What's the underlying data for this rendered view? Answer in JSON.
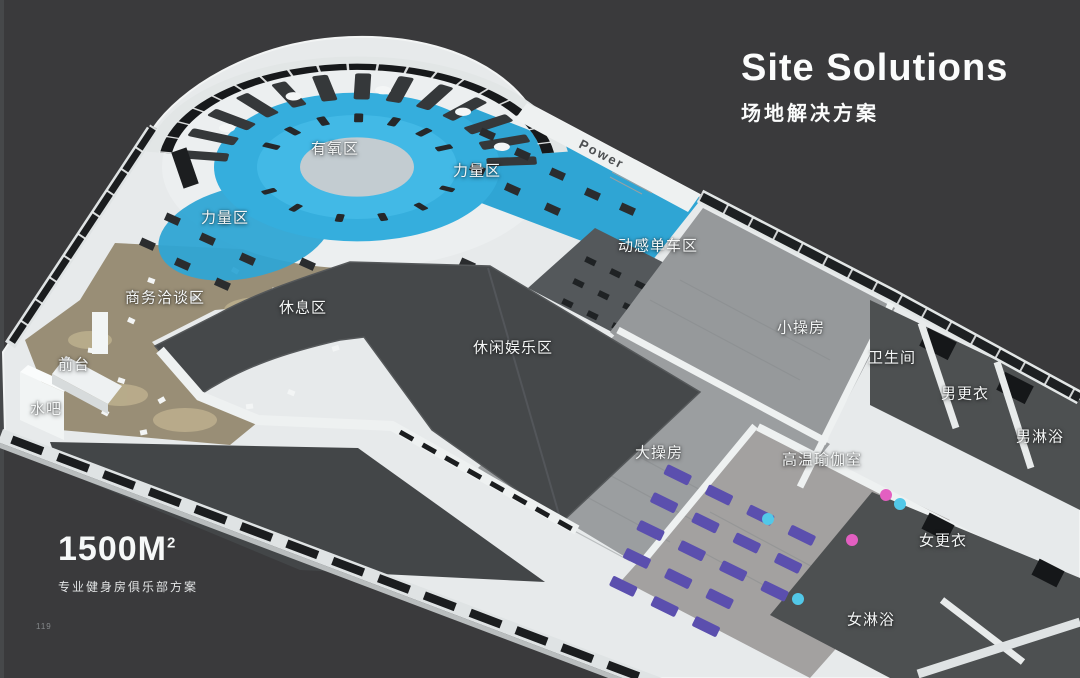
{
  "page": {
    "title": "Site Solutions",
    "subtitle": "场地解决方案",
    "area_value": "1500M",
    "area_sup": "2",
    "area_caption": "专业健身房俱乐部方案",
    "page_number": "119"
  },
  "floorplan": {
    "wall_text": "Power",
    "zones": [
      {
        "id": "aerobic",
        "label": "有氧区"
      },
      {
        "id": "strength-right",
        "label": "力量区"
      },
      {
        "id": "strength-left",
        "label": "力量区"
      },
      {
        "id": "spinning",
        "label": "动感单车区"
      },
      {
        "id": "business",
        "label": "商务洽谈区"
      },
      {
        "id": "rest",
        "label": "休息区"
      },
      {
        "id": "small-studio",
        "label": "小操房"
      },
      {
        "id": "toilet",
        "label": "卫生间"
      },
      {
        "id": "front-desk",
        "label": "前台"
      },
      {
        "id": "mens-locker",
        "label": "男更衣"
      },
      {
        "id": "water-bar",
        "label": "水吧"
      },
      {
        "id": "leisure",
        "label": "休闲娱乐区"
      },
      {
        "id": "mens-shower",
        "label": "男淋浴"
      },
      {
        "id": "big-studio",
        "label": "大操房"
      },
      {
        "id": "hot-yoga",
        "label": "高温瑜伽室"
      },
      {
        "id": "womens-locker",
        "label": "女更衣"
      },
      {
        "id": "womens-shower",
        "label": "女淋浴"
      }
    ],
    "colors": {
      "background": "#3a3a3c",
      "floor_white": "#e7eaeb",
      "aerobic_blue": "#35aedd",
      "blue_deep": "#2fa5d4",
      "donut_center": "#c3ccd1",
      "roof_dark": "#45484a",
      "room_roof": "#4d5051",
      "wood_gray": "#9b9ea0",
      "carpet_tan": "#998e76",
      "yoga_mat_purple": "#5b4fae",
      "ball_pink": "#e35fc1",
      "ball_cyan": "#52c8e8",
      "glass_dark": "#1b1d1f"
    }
  }
}
